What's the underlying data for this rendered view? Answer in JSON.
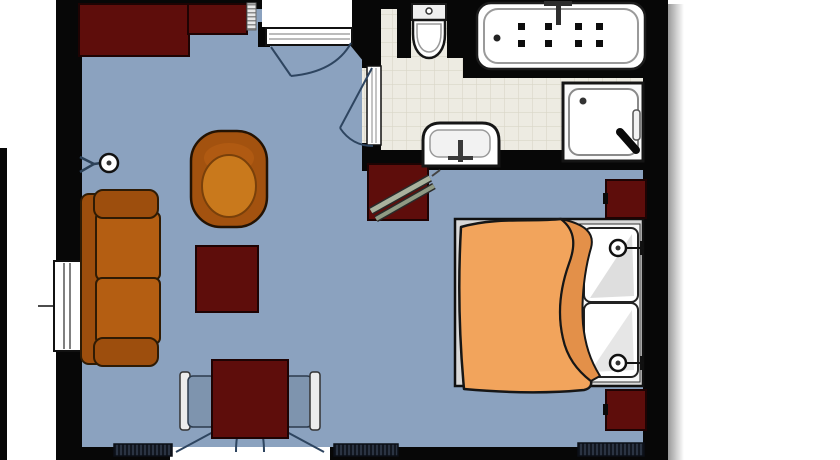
{
  "plan": {
    "kind": "floor-plan",
    "rooms": [
      {
        "name": "living-sleeping-area",
        "floor_color_key": "floor"
      },
      {
        "name": "bathroom",
        "floor_color_key": "tile"
      }
    ],
    "furniture": [
      "sideboard",
      "wall-lamp",
      "sofa",
      "armchair",
      "coffee-table",
      "dining-table",
      "dining-chair-left",
      "dining-chair-right",
      "tv-stand",
      "tv",
      "double-bed",
      "pillows",
      "duvet",
      "nightstand-top",
      "nightstand-bottom",
      "bed-wall-lamp-top",
      "bed-wall-lamp-bottom",
      "radiator-left",
      "radiator-middle",
      "radiator-bedroom"
    ],
    "bathroom_fixtures": [
      "toilet",
      "jetted-bathtub",
      "shower",
      "washbasin"
    ],
    "doors": [
      "entry-door",
      "bathroom-door",
      "french-balcony-doors"
    ],
    "windows": [
      "left-wall-window"
    ]
  },
  "colors": {
    "outside": "#ffffff",
    "wall": "#070707",
    "floor": "#8ba2bf",
    "tile": "#edebe2",
    "tile_line": "#d9d6c7",
    "maroon": "#5e0d0b",
    "maroon_edge": "#1e0303",
    "sofa_orange": "#b45e12",
    "sofa_dark": "#9d4e0d",
    "sofa_outline": "#2f1b04",
    "armchair_inner": "#c9791c",
    "blanket": "#f2a45c",
    "blanket_fold": "#e39049",
    "chair_seat": "#7e94ae",
    "bed_frame": "#d8d8d8",
    "door_arc": "#2e4560",
    "radiator": "#232b3a",
    "fixture_white": "#ffffff",
    "tv_screen": "#aab29e"
  }
}
